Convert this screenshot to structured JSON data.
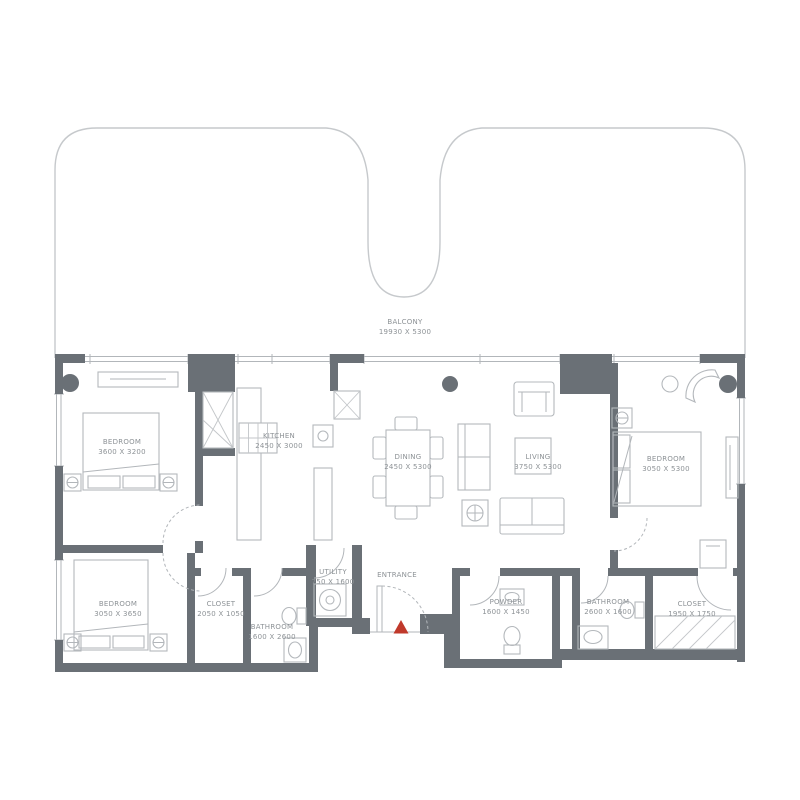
{
  "title": "Apartment floor plan",
  "colors": {
    "wall": "#6a7076",
    "furniture_line": "#b4b8bc",
    "balcony_line": "#c6c9cc",
    "label_text": "#8d9296",
    "accent_red": "#c0392b"
  },
  "rooms": [
    {
      "id": "balcony",
      "name": "BALCONY",
      "dims": "19930 X 5300"
    },
    {
      "id": "bedroom-1",
      "name": "BEDROOM",
      "dims": "3600 X 3200"
    },
    {
      "id": "kitchen",
      "name": "KITCHEN",
      "dims": "2450 X 3000"
    },
    {
      "id": "dining",
      "name": "DINING",
      "dims": "2450 X 5300"
    },
    {
      "id": "living",
      "name": "LIVING",
      "dims": "3750 X 5300"
    },
    {
      "id": "bedroom-2",
      "name": "BEDROOM",
      "dims": "3050 X 5300"
    },
    {
      "id": "bedroom-3",
      "name": "BEDROOM",
      "dims": "3050 X 3650"
    },
    {
      "id": "closet-1",
      "name": "CLOSET",
      "dims": "2050 X 1050"
    },
    {
      "id": "bathroom-1",
      "name": "BATHROOM",
      "dims": "1600 X 2600"
    },
    {
      "id": "utility",
      "name": "UTILITY",
      "dims": "750 X 1600"
    },
    {
      "id": "entrance",
      "name": "ENTRANCE",
      "dims": ""
    },
    {
      "id": "powder",
      "name": "POWDER",
      "dims": "1600 X 1450"
    },
    {
      "id": "bathroom-2",
      "name": "BATHROOM",
      "dims": "2600 X 1600"
    },
    {
      "id": "closet-2",
      "name": "CLOSET",
      "dims": "1950 X 1750"
    }
  ]
}
